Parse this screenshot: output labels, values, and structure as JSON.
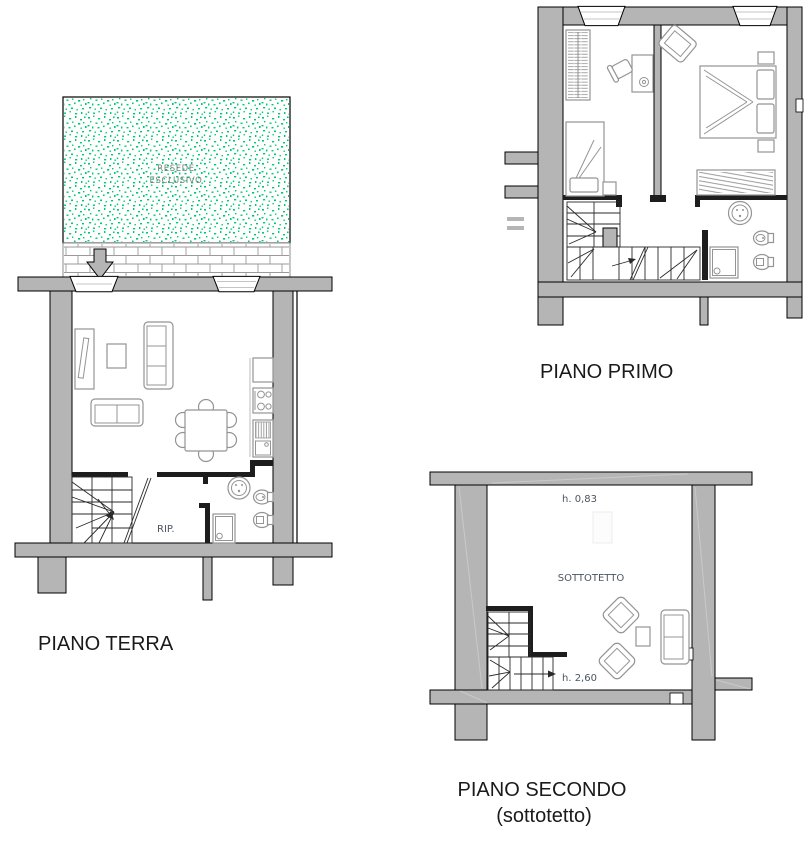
{
  "document": {
    "type": "cadastral-floor-plan",
    "floors": {
      "ground": {
        "title": "PIANO TERRA",
        "garden_label_line1": "RESEDE",
        "garden_label_line2": "ESCLUSIVO",
        "storage_label": "RIP."
      },
      "first": {
        "title": "PIANO PRIMO"
      },
      "second": {
        "title": "PIANO SECONDO",
        "subtitle": "(sottotetto)",
        "room_label": "SOTTOTETTO",
        "height_top": "h. 0,83",
        "height_bottom": "h. 2,60"
      }
    },
    "colors": {
      "wall_gray": "#b5b5b5",
      "outline_black": "#000000",
      "furniture_gray": "#949494",
      "garden_green": "#00c878",
      "brick_gray": "#9a9a9a",
      "small_label": "#4a5560",
      "garden_label": "#6e8582",
      "title_text": "#1a1a1a"
    }
  }
}
